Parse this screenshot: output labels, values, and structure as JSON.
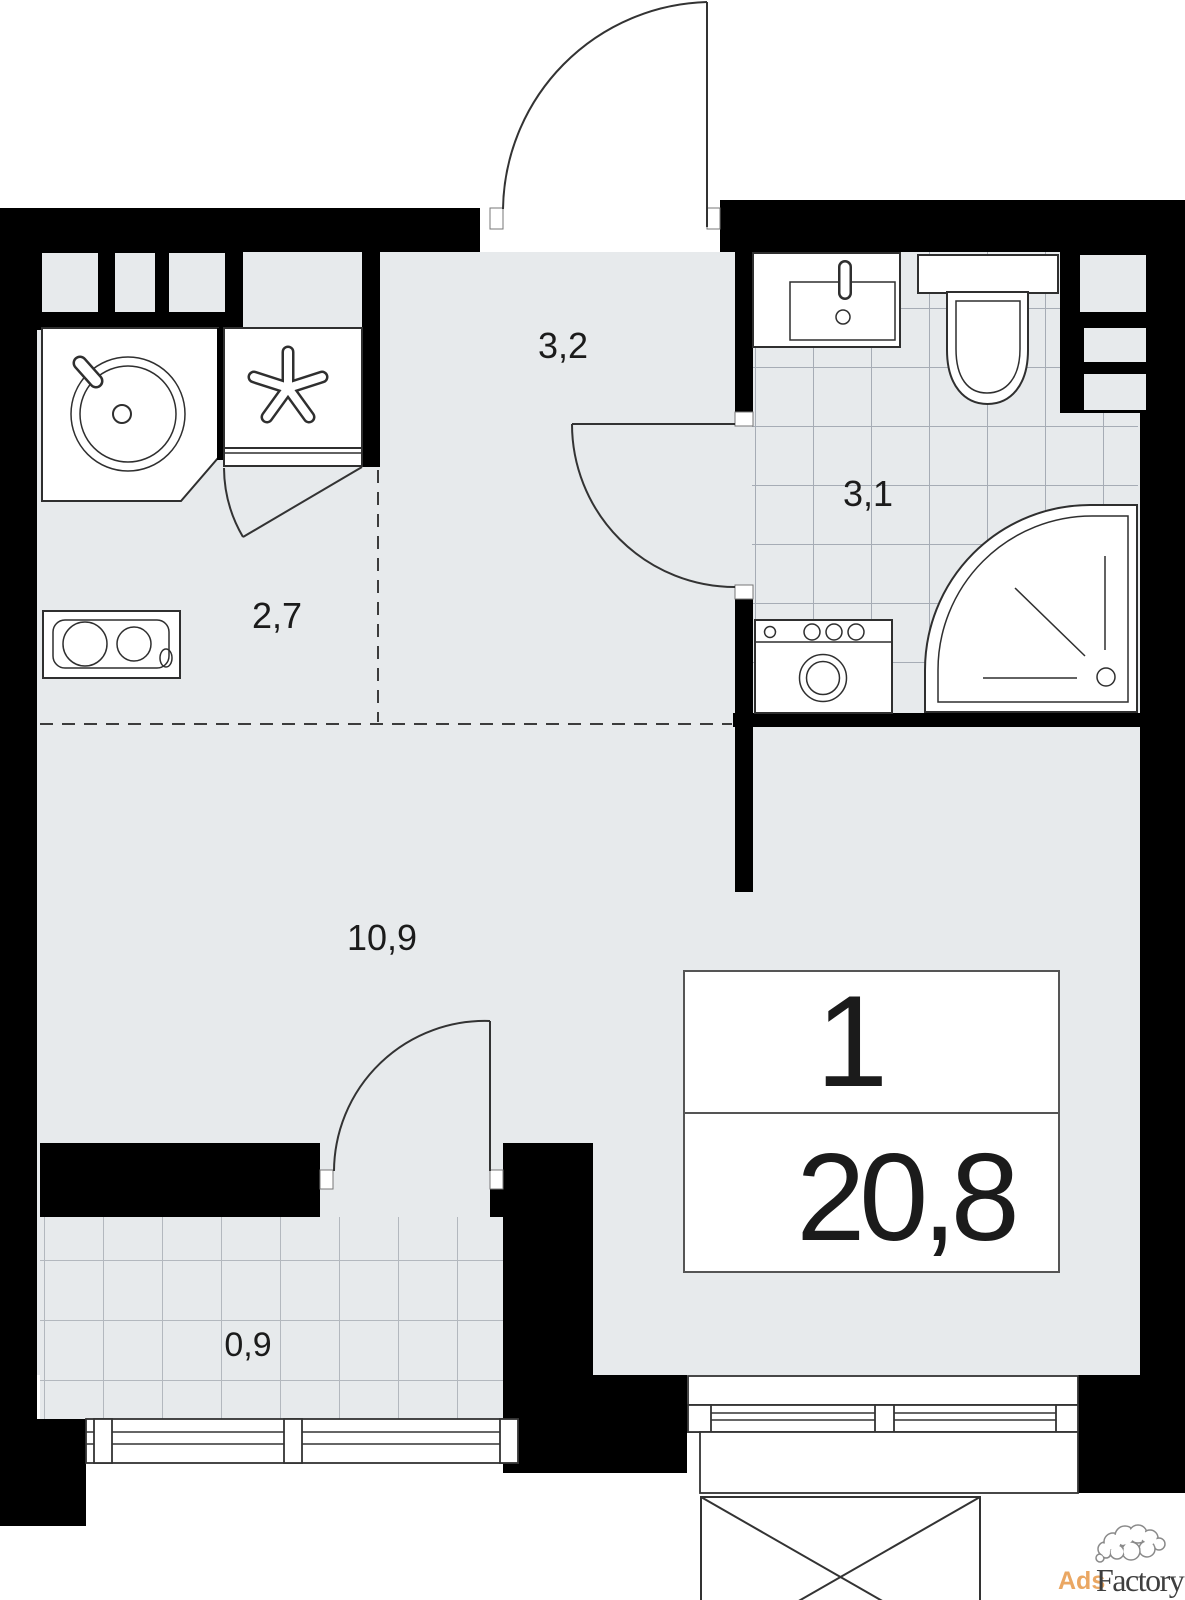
{
  "plan": {
    "unit": {
      "rooms_count": "1",
      "total_area": "20,8"
    },
    "rooms": [
      {
        "name": "hallway",
        "area": "3,2"
      },
      {
        "name": "bathroom",
        "area": "3,1"
      },
      {
        "name": "kitchen-zone",
        "area": "2,7"
      },
      {
        "name": "living-room",
        "area": "10,9"
      },
      {
        "name": "balcony",
        "area": "0,9"
      }
    ],
    "fixtures": [
      "kitchen-sink",
      "refrigerator-asterisk",
      "stove",
      "closet-door",
      "bathroom-sink",
      "toilet",
      "shower",
      "washing-machine",
      "ventilation-shaft",
      "entrance-door",
      "bathroom-door",
      "balcony-door",
      "balcony-window",
      "living-room-window"
    ]
  },
  "watermark": {
    "prefix": "Ads",
    "suffix": "Factory"
  },
  "colors": {
    "background": "#ffffff",
    "wall": "#000000",
    "floor": "#e7eaec",
    "tile_line_bathroom": "#a6acb5",
    "tile_line_balcony": "#b3b8be",
    "fixture_outline": "#2f2f2f",
    "watermark_orange": "#eaa763",
    "watermark_dark": "#3f3f3f"
  }
}
